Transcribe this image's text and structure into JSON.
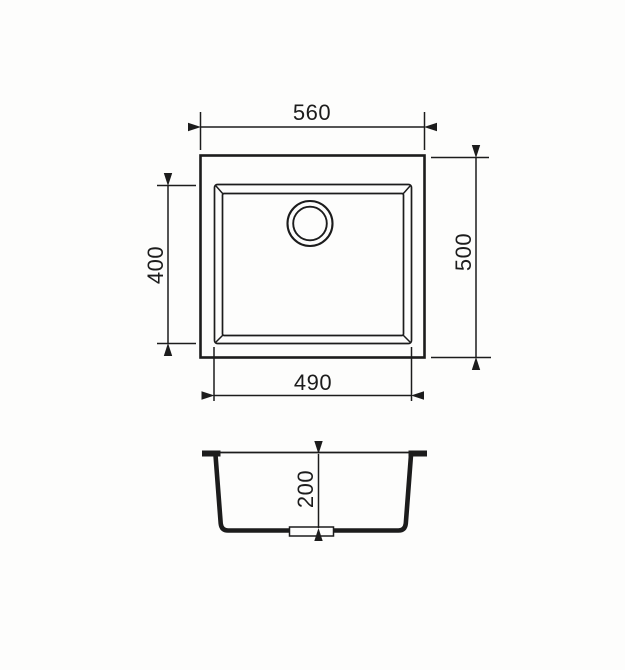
{
  "colors": {
    "background": "#fdfdfc",
    "line": "#1c1c1c"
  },
  "dimensions": {
    "overall_width": "560",
    "overall_depth": "500",
    "bowl_depth": "400",
    "bowl_width": "490",
    "bowl_height": "200"
  }
}
